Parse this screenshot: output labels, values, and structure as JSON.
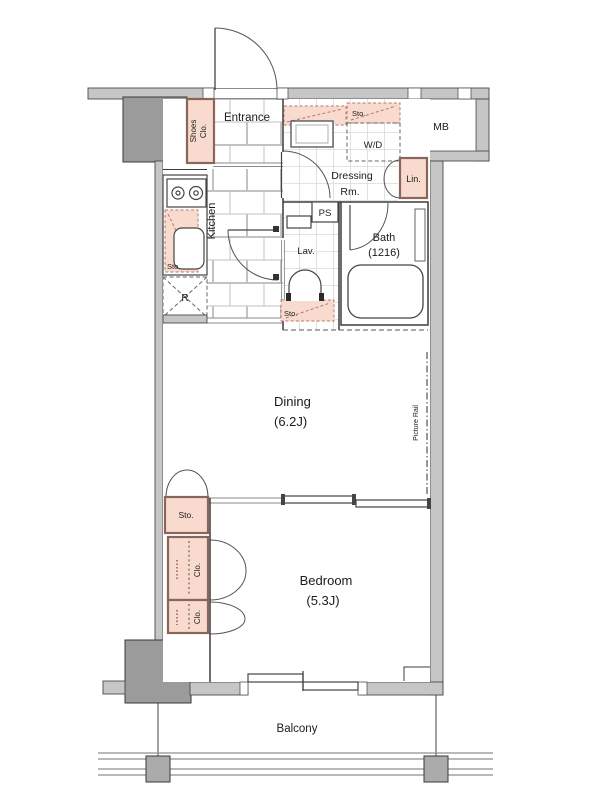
{
  "palette": {
    "storage_fill": "#f8dbce",
    "storage_border": "#8a655b",
    "wall_fill": "#c6c6c6",
    "pillar_fill": "#9b9b9b",
    "line_color": "#3c3c3c"
  },
  "rooms": {
    "entrance": "Entrance",
    "kitchen": "Kitchen",
    "dressing_line1": "Dressing",
    "dressing_line2": "Rm.",
    "lavatory": "Lav.",
    "bath": "Bath",
    "bath_size": "(1216)",
    "dining": "Dining",
    "dining_size": "(6.2J)",
    "bedroom": "Bedroom",
    "bedroom_size": "(5.3J)",
    "balcony": "Balcony"
  },
  "storage": {
    "shoes_line1": "Shoes",
    "shoes_line2": "Clo.",
    "kitchen_sto": "Sto.",
    "wd_sto": "Sto.",
    "lav_sto": "Sto.",
    "dining_sto": "Sto.",
    "closet_upper": "Clo.",
    "closet_lower": "Clo.",
    "linen": "Lin."
  },
  "fixtures": {
    "washer_dryer": "W/D",
    "pipe_space": "PS",
    "meter_box": "MB",
    "refrigerator": "R",
    "picture_rail": "Picture Rail"
  }
}
